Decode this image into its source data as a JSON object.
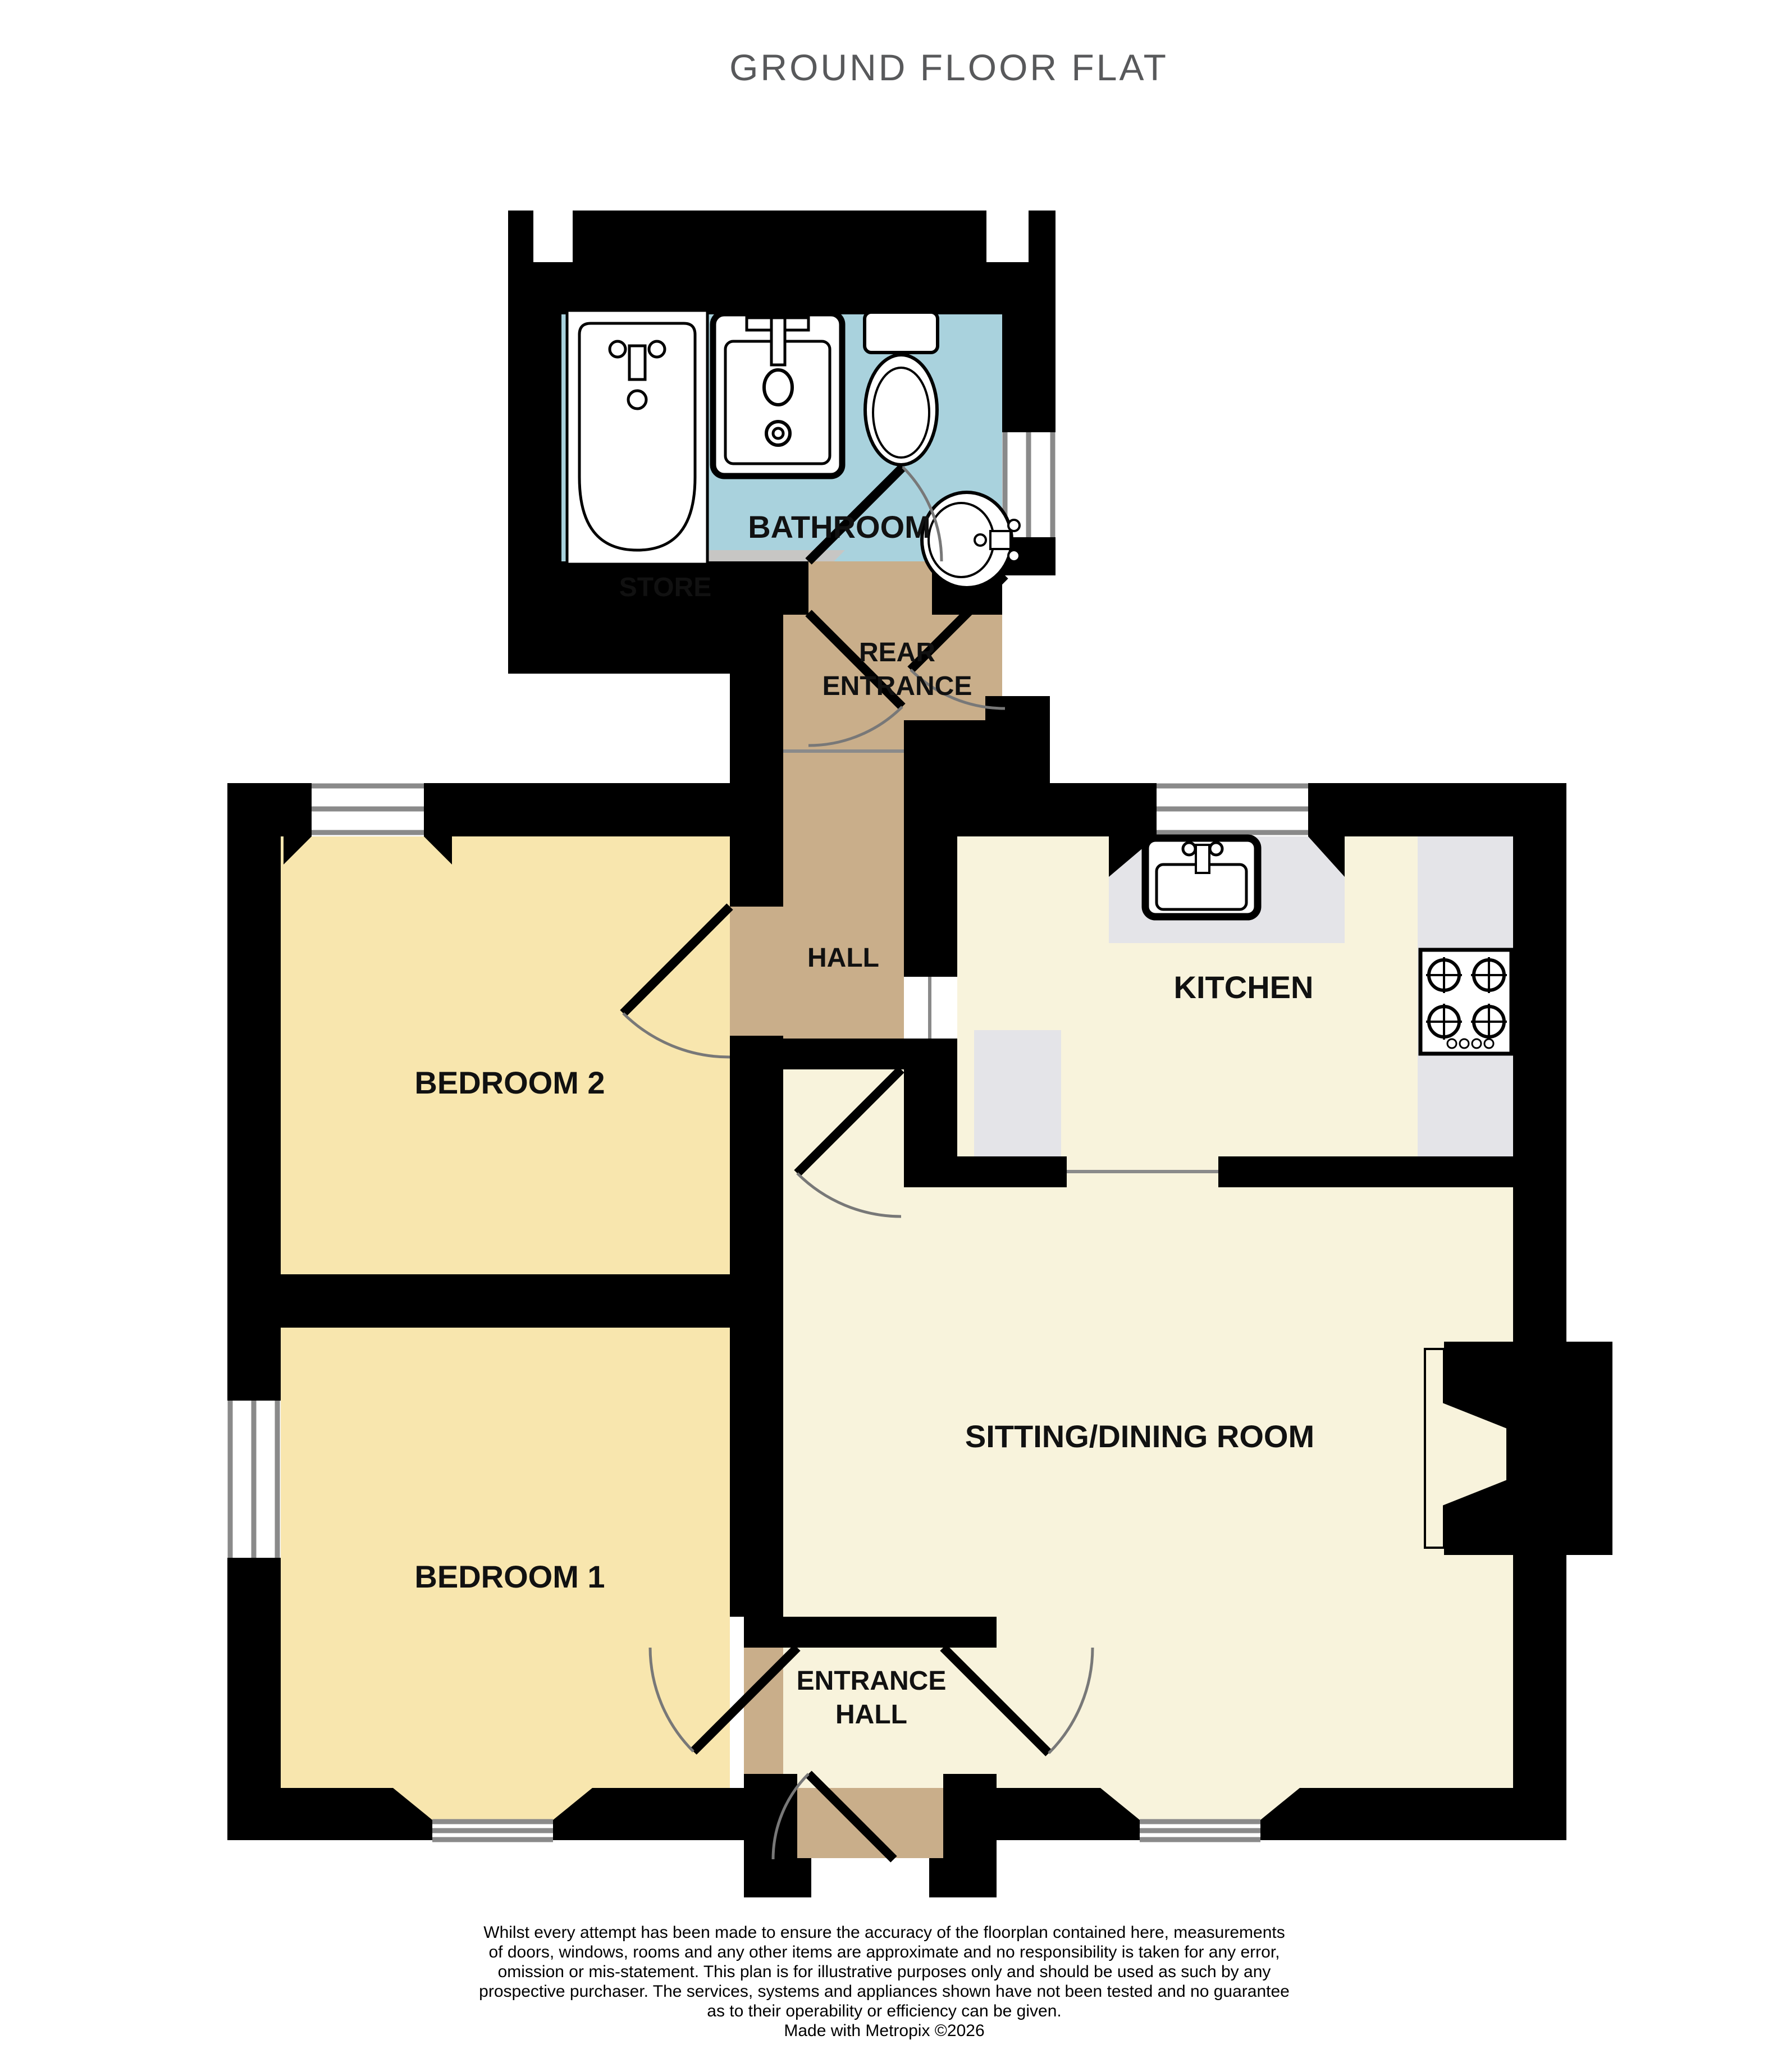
{
  "title": "GROUND FLOOR FLAT",
  "rooms": {
    "bathroom": {
      "label": "BATHROOM"
    },
    "store": {
      "label": "STORE"
    },
    "rear_entrance": {
      "line1": "REAR",
      "line2": "ENTRANCE"
    },
    "hall": {
      "label": "HALL"
    },
    "kitchen": {
      "label": "KITCHEN"
    },
    "bedroom2": {
      "label": "BEDROOM 2"
    },
    "bedroom1": {
      "label": "BEDROOM 1"
    },
    "sitting": {
      "label": "SITTING/DINING ROOM"
    },
    "entrance_hall": {
      "line1": "ENTRANCE",
      "line2": "HALL"
    }
  },
  "icons": {
    "bath": "bath-icon",
    "shower_basin": "square-basin-icon",
    "toilet": "toilet-icon",
    "wash_basin": "round-basin-icon",
    "kitchen_sink": "kitchen-sink-icon",
    "hob": "cooker-hob-icon"
  },
  "colors": {
    "wall": "#000000",
    "bathroom": "#A9D2DD",
    "bedroom": "#F8E6AE",
    "living": "#F8F3DC",
    "hallway": "#C9AE8A",
    "store": "#C7C6C4",
    "counter": "#E4E4E8",
    "window_line": "#8A8A8A",
    "door_arc": "#787878",
    "exterior": "#FFFFFF",
    "title_text": "#58595B",
    "label_text": "#111111",
    "disclaimer_text": "#000000"
  },
  "disclaimer": {
    "lines": [
      "Whilst every attempt has been made to ensure the accuracy of the floorplan contained here, measurements",
      "of doors, windows, rooms and any other items are approximate and no responsibility is taken for any error,",
      "omission or mis-statement. This plan is for illustrative purposes only and should be used as such by any",
      "prospective purchaser. The services, systems and appliances shown have not been tested and no guarantee",
      "as to their operability or efficiency can be given.",
      "Made with Metropix ©2026"
    ]
  }
}
